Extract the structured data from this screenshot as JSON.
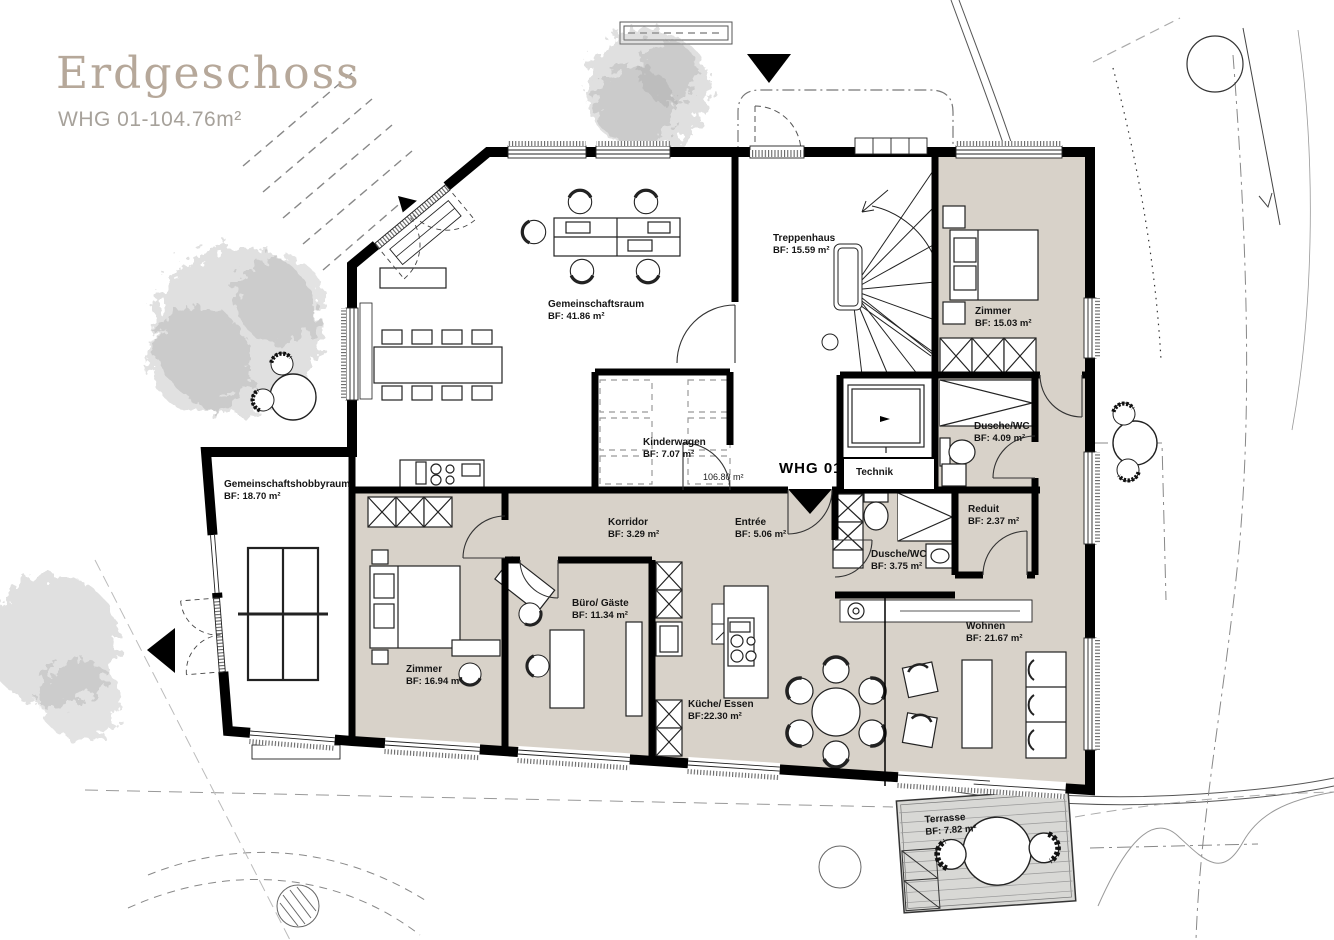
{
  "header": {
    "title": "Erdgeschoss",
    "subtitle": "WHG 01-104.76m²"
  },
  "marker": {
    "whg_label": "WHG 01",
    "area_note": "106.80 m²"
  },
  "colors": {
    "apartment_fill": "#d8d2c9",
    "wall": "#000000",
    "title_accent": "#b6a89a",
    "terrace_fill": "#d8d8d5",
    "site_line": "#999999"
  },
  "rooms": {
    "gemeinschaftsraum": {
      "name": "Gemeinschaftsraum",
      "area": "BF: 41.86 m²"
    },
    "treppenhaus": {
      "name": "Treppenhaus",
      "area": "BF: 15.59 m²"
    },
    "zimmer_top": {
      "name": "Zimmer",
      "area": "BF: 15.03 m²"
    },
    "dusche_wc_top": {
      "name": "Dusche/WC",
      "area": "BF: 4.09 m²"
    },
    "kinderwagen": {
      "name": "Kinderwagen",
      "area": "BF: 7.07 m²"
    },
    "technik": {
      "name": "Technik",
      "area": ""
    },
    "gemeinschaftshobbyraum": {
      "name": "Gemeinschaftshobbyraum",
      "area": "BF: 18.70 m²"
    },
    "korridor": {
      "name": "Korridor",
      "area": "BF: 3.29 m²"
    },
    "entree": {
      "name": "Entrée",
      "area": "BF: 5.06 m²"
    },
    "dusche_wc": {
      "name": "Dusche/WC",
      "area": "BF: 3.75 m²"
    },
    "reduit": {
      "name": "Reduit",
      "area": "BF: 2.37 m²"
    },
    "zimmer": {
      "name": "Zimmer",
      "area": "BF: 16.94 m²"
    },
    "buero_gaeste": {
      "name": "Büro/ Gäste",
      "area": "BF: 11.34 m²"
    },
    "kueche_essen": {
      "name": "Küche/ Essen",
      "area": "BF:22.30 m²"
    },
    "wohnen": {
      "name": "Wohnen",
      "area": "BF: 21.67 m²"
    },
    "terrasse": {
      "name": "Terrasse",
      "area": "BF: 7.82 m²"
    }
  }
}
